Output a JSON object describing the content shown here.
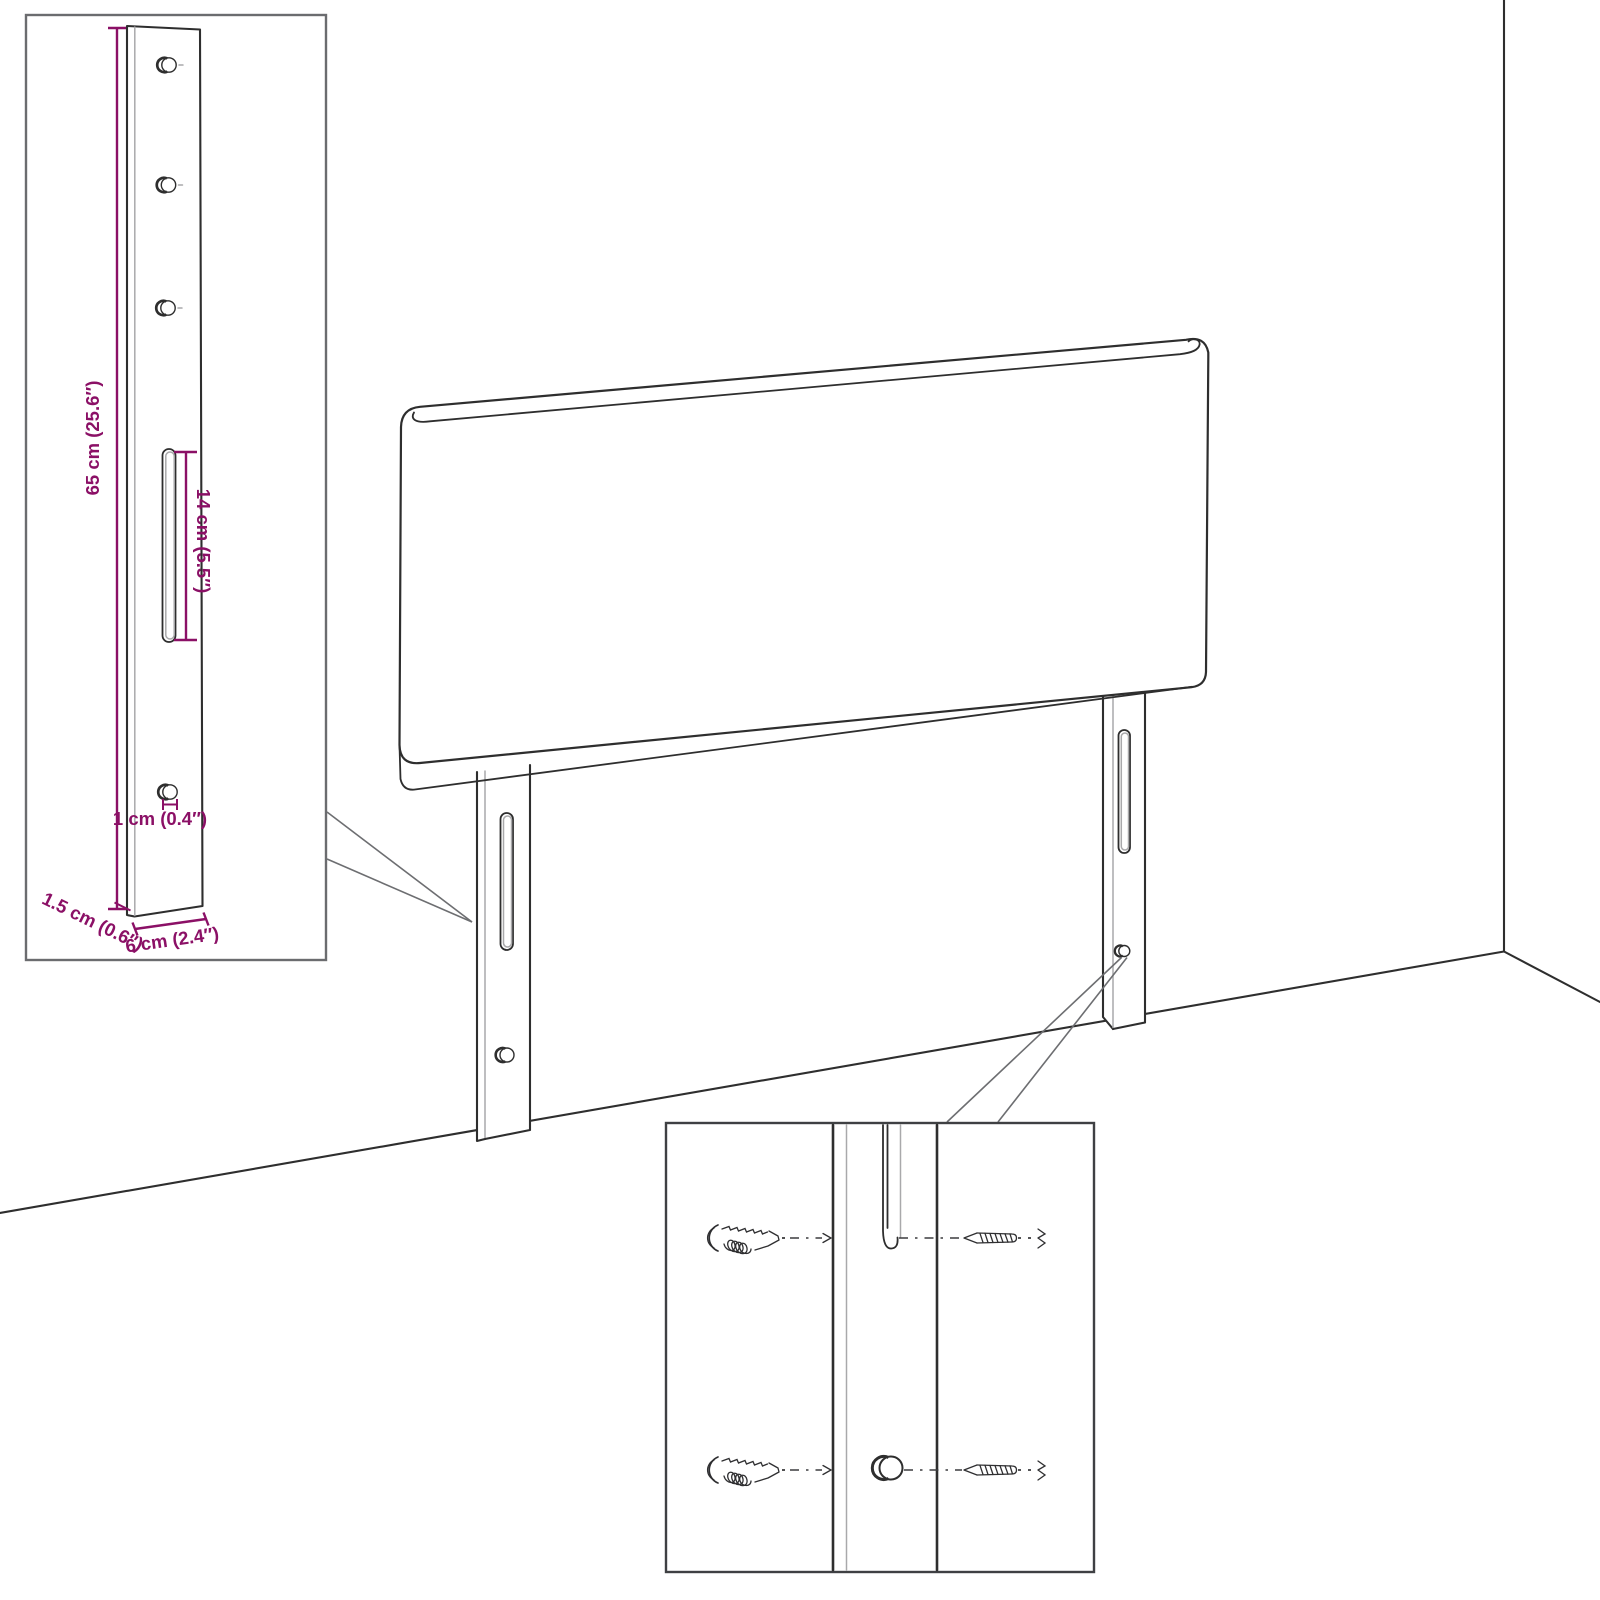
{
  "diagram": {
    "kind": "headboard assembly dimension diagram",
    "dimension_labels": {
      "height": "65 cm (25.6″)",
      "slot_length": "14 cm (5.5″)",
      "hole_diameter": "1 cm (0.4″)",
      "thickness": "1.5 cm (0.6″)",
      "width": "6 cm (2.4″)"
    },
    "insets": {
      "left_inset": "mounting-leg dimension view with 4 screw holes and adjustment slot",
      "bottom_inset": "close-up of leg slot and hole with wall plugs and screws"
    },
    "icons": {
      "wall_plug_icon": "ribbed wall anchor pictograph",
      "screw_icon": "pointed screw pictograph",
      "slot_icon": "elongated adjustment slot",
      "hole_icon": "round screw hole"
    }
  },
  "colors": {
    "accent": "#8b1066",
    "line": "#2e2e2e",
    "leader": "#6d6e71",
    "highlight": "#a9a9ab",
    "inset_border_left": "#6b6c6f",
    "inset_border_bottom": "#3f4043",
    "background": "#ffffff"
  }
}
